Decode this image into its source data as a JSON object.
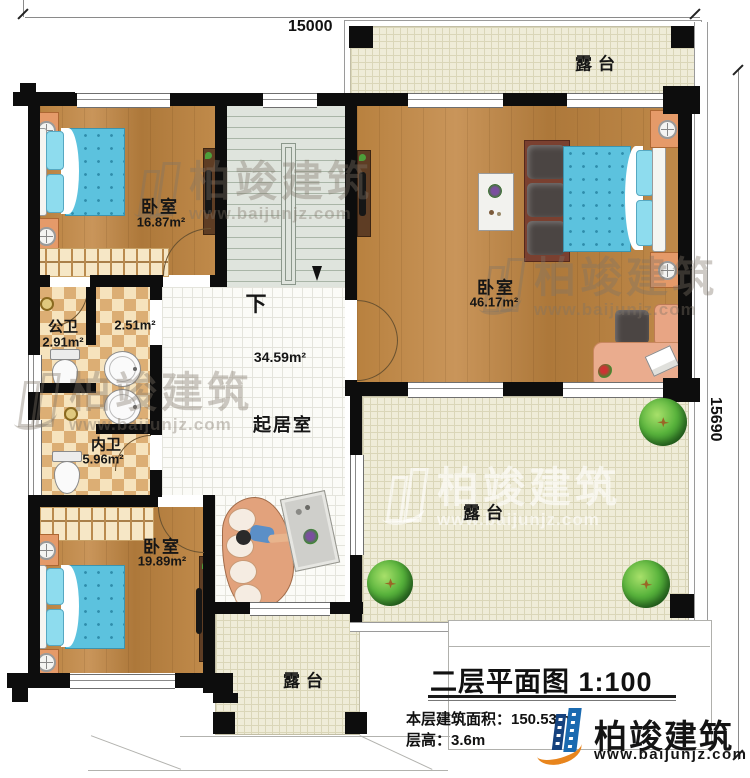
{
  "plan": {
    "dim_top": "15000",
    "dim_right": "15690",
    "stair_direction": "下",
    "rooms": {
      "bedroom_tl": {
        "name": "卧室",
        "area": "16.87m²"
      },
      "bedroom_r": {
        "name": "卧室",
        "area": "46.17m²"
      },
      "bedroom_bl": {
        "name": "卧室",
        "area": "19.89m²"
      },
      "bath_public": {
        "name": "公卫",
        "area": "2.91m²"
      },
      "wash_area": {
        "area": "2.51m²"
      },
      "bath_private": {
        "name": "内卫",
        "area": "5.96m²"
      },
      "living": {
        "name": "起居室",
        "area": "34.59m²"
      },
      "terrace": {
        "name": "露台"
      }
    }
  },
  "title_block": {
    "title": "二层平面图",
    "scale": "1:100",
    "area_label": "本层建筑面积：150.53m²",
    "floor_height_label": "层高：3.6m"
  },
  "brand": {
    "name": "柏竣建筑",
    "website": "www.baijunjz.com"
  },
  "colors": {
    "wall": "#0d0d0d",
    "wood": "#bd8a48",
    "terrace": "#efecd8",
    "bed_blue": "#5cc2de",
    "brand_blue": "#1b6ab0",
    "brand_orange": "#e8851d"
  }
}
